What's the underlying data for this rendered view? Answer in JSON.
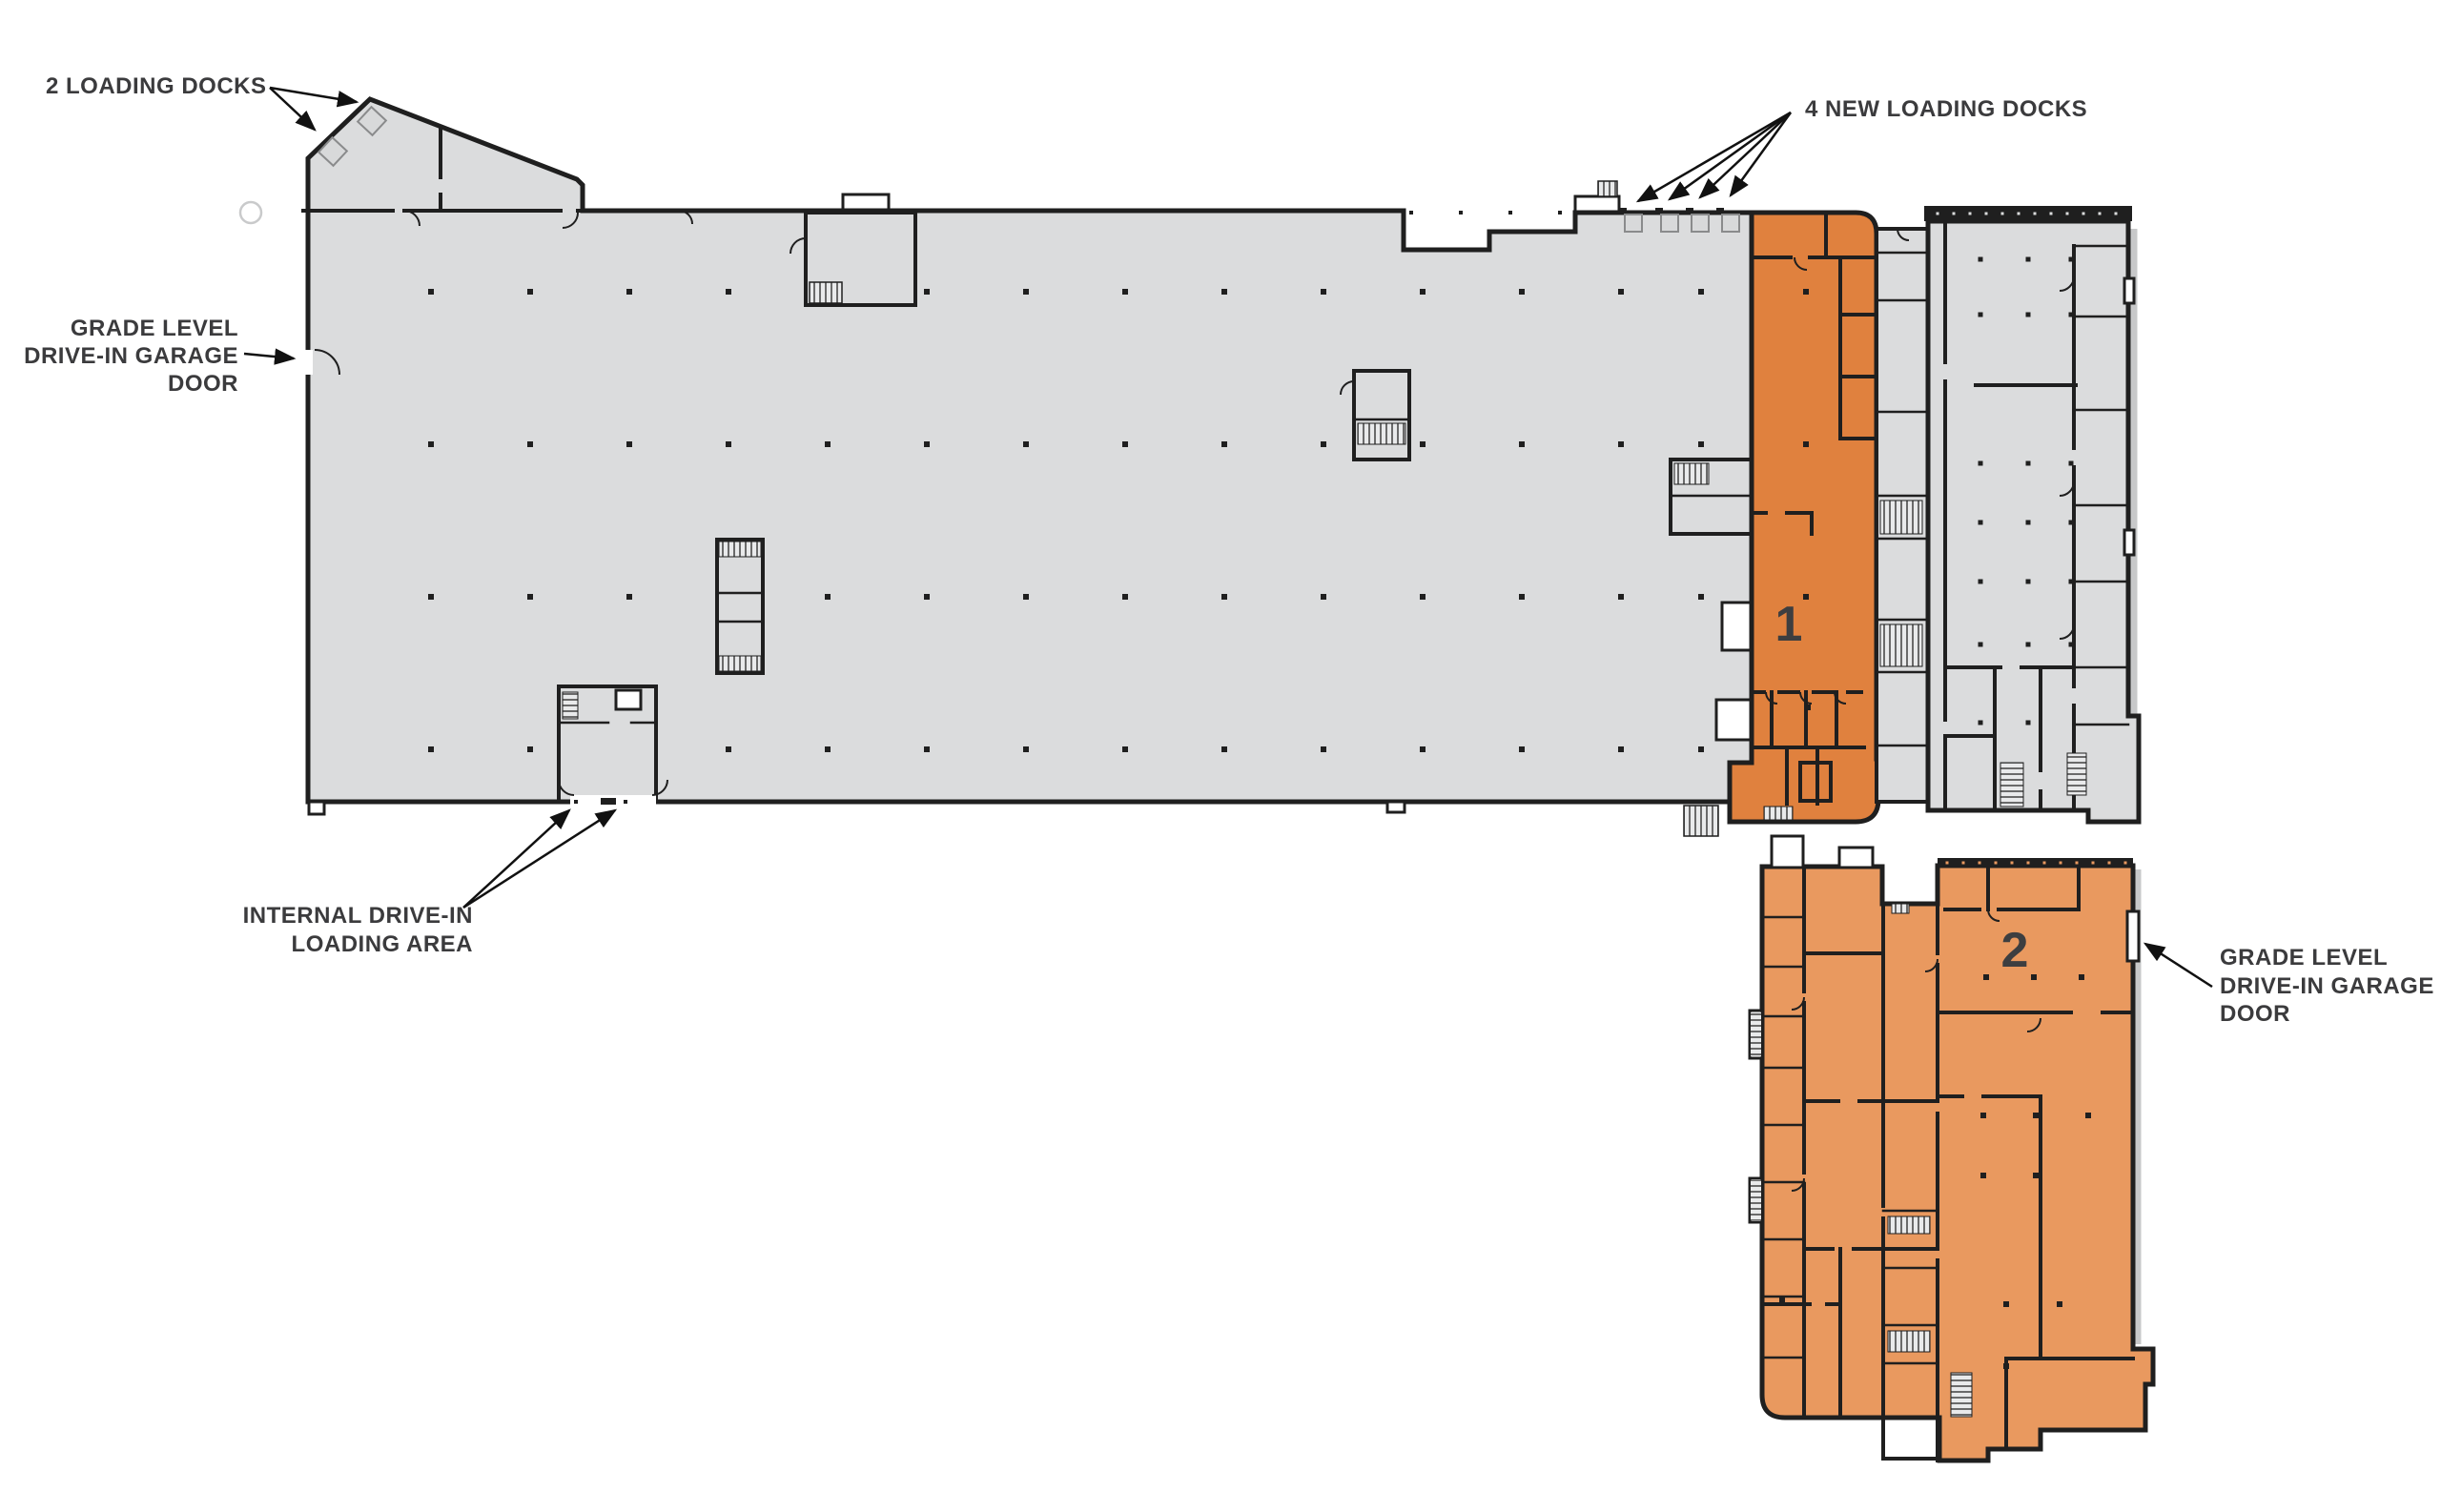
{
  "document_type": "building-floor-plan-siteplan",
  "colors": {
    "suite1": "#E0813E",
    "suite2": "#E9995F",
    "floor_gray": "#DBDCDD",
    "wall": "#1F1F1F",
    "label_text": "#3B3B3D"
  },
  "labels": {
    "docks2": "2 LOADING DOCKS",
    "docks4": "4 NEW LOADING DOCKS",
    "grade_left": [
      "GRADE LEVEL",
      "DRIVE-IN GARAGE",
      "DOOR"
    ],
    "internal": [
      "INTERNAL DRIVE-IN",
      "LOADING AREA"
    ],
    "grade_right": [
      "GRADE LEVEL",
      "DRIVE-IN GARAGE",
      "DOOR"
    ]
  },
  "suites": {
    "suite1_number": "1",
    "suite2_number": "2"
  }
}
